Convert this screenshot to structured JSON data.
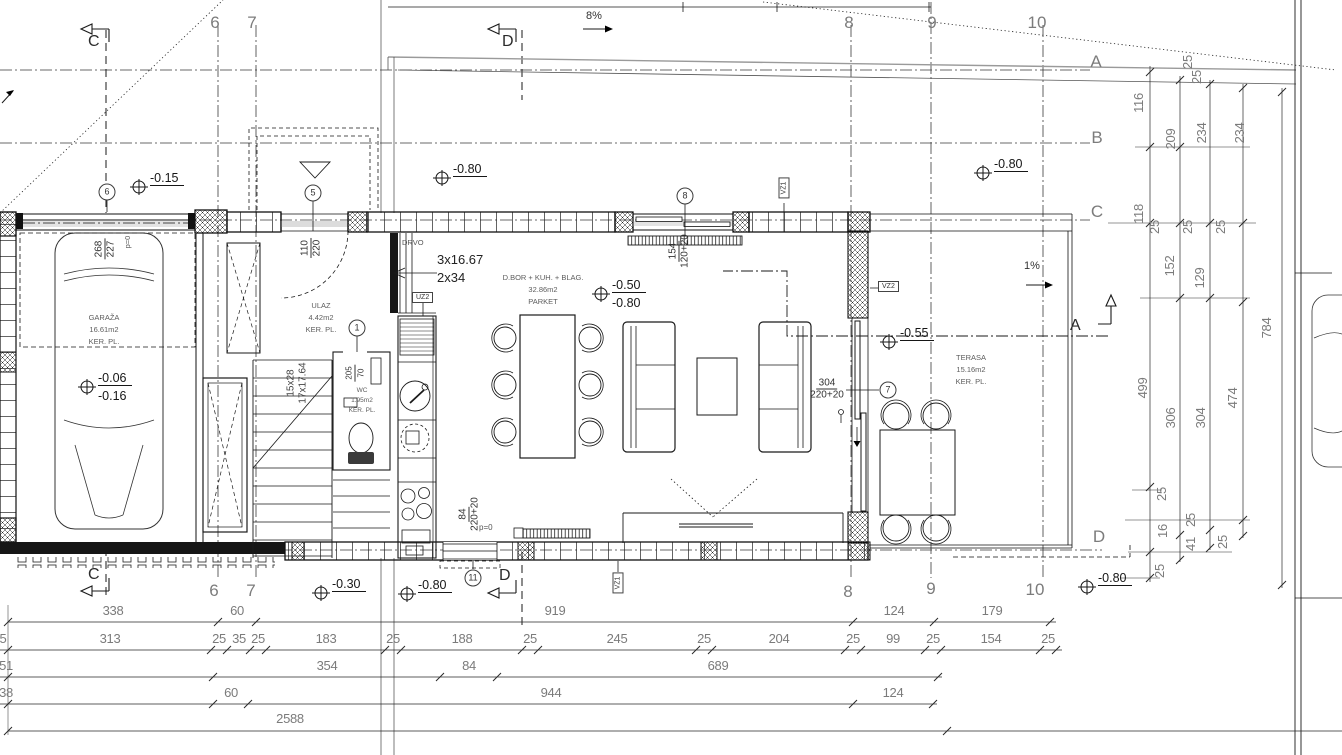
{
  "rooms": {
    "garage": {
      "name": "GARAŽA",
      "area": "16.61m2",
      "floor": "KER. PL."
    },
    "entry": {
      "name": "ULAZ",
      "area": "4.42m2",
      "floor": "KER. PL."
    },
    "wc": {
      "name": "WC",
      "area": "1.95m2",
      "floor": "KER. PL."
    },
    "living": {
      "name": "D.BOR + KUH. + BLAG.",
      "area": "32.86m2",
      "floor": "PARKET"
    },
    "terrace": {
      "name": "TERASA",
      "area": "15.16m2",
      "floor": "KER. PL."
    }
  },
  "sections": {
    "c": "C",
    "d": "D",
    "a": "A"
  },
  "slopes": {
    "driveway": "8%",
    "terrace": "1%"
  },
  "stairs": {
    "note1": "3x16.67",
    "note2": "2x34",
    "flight1": "15x28",
    "flight2": "17x17.64"
  },
  "annotations": {
    "drvo": "DRVO",
    "uz2": "UZ2",
    "vz1": "VZ1",
    "vz2": "VZ2",
    "vz1_bottom": "VZ1",
    "p0_kitchen": "p=0",
    "p0_garage": "p=0"
  },
  "door_dims": {
    "entry_top": "110",
    "entry_bottom": "220",
    "garage_top": "268",
    "garage_bottom": "227",
    "wc_top": "205",
    "wc_bottom": "70",
    "window_top": "154",
    "window_bottom": "120+20",
    "kitchen_top": "84",
    "kitchen_bottom": "220+20",
    "slider_top": "304",
    "slider_bottom": "220+20"
  },
  "grid_labels": [
    {
      "t": "6",
      "x": 215,
      "y": 14
    },
    {
      "t": "7",
      "x": 252,
      "y": 14
    },
    {
      "t": "8",
      "x": 849,
      "y": 14
    },
    {
      "t": "9",
      "x": 932,
      "y": 14
    },
    {
      "t": "10",
      "x": 1037,
      "y": 14
    },
    {
      "t": "6",
      "x": 214,
      "y": 582
    },
    {
      "t": "7",
      "x": 251,
      "y": 582
    },
    {
      "t": "8",
      "x": 848,
      "y": 583
    },
    {
      "t": "9",
      "x": 931,
      "y": 580
    },
    {
      "t": "10",
      "x": 1035,
      "y": 581
    },
    {
      "t": "A",
      "x": 1096,
      "y": 53
    },
    {
      "t": "B",
      "x": 1097,
      "y": 129
    },
    {
      "t": "C",
      "x": 1097,
      "y": 203
    },
    {
      "t": "D",
      "x": 1099,
      "y": 528
    }
  ],
  "position_markers": [
    {
      "t": "6",
      "x": 107,
      "y": 192
    },
    {
      "t": "5",
      "x": 313,
      "y": 193
    },
    {
      "t": "8",
      "x": 685,
      "y": 196
    },
    {
      "t": "1",
      "x": 357,
      "y": 328
    },
    {
      "t": "7",
      "x": 888,
      "y": 390
    },
    {
      "t": "11",
      "x": 473,
      "y": 578
    }
  ],
  "level_markers": [
    {
      "t": "-0.15",
      "x": 150,
      "y": 171,
      "u": 1
    },
    {
      "t": "-0.80",
      "x": 453,
      "y": 162,
      "u": 1
    },
    {
      "t": "-0.80",
      "x": 994,
      "y": 157,
      "u": 1
    },
    {
      "t": "-0.50",
      "x": 612,
      "y": 278,
      "u": 1
    },
    {
      "t": "-0.80",
      "x": 612,
      "y": 296
    },
    {
      "t": "-0.06",
      "x": 98,
      "y": 371,
      "u": 1
    },
    {
      "t": "-0.16",
      "x": 98,
      "y": 389
    },
    {
      "t": "-0.55",
      "x": 900,
      "y": 326,
      "u": 1
    },
    {
      "t": "-0.30",
      "x": 332,
      "y": 577,
      "u": 1
    },
    {
      "t": "-0.80",
      "x": 418,
      "y": 578,
      "u": 1
    },
    {
      "t": "-0.80",
      "x": 1098,
      "y": 571,
      "u": 1
    }
  ],
  "dim_labels_bottom": [
    {
      "t": "338",
      "x": 113,
      "y": 604
    },
    {
      "t": "60",
      "x": 237,
      "y": 604
    },
    {
      "t": "919",
      "x": 555,
      "y": 604
    },
    {
      "t": "124",
      "x": 894,
      "y": 604
    },
    {
      "t": "179",
      "x": 992,
      "y": 604
    },
    {
      "t": "5",
      "x": 3,
      "y": 632
    },
    {
      "t": "313",
      "x": 110,
      "y": 632
    },
    {
      "t": "25",
      "x": 219,
      "y": 632
    },
    {
      "t": "35",
      "x": 239,
      "y": 632
    },
    {
      "t": "25",
      "x": 258,
      "y": 632
    },
    {
      "t": "183",
      "x": 326,
      "y": 632
    },
    {
      "t": "25",
      "x": 393,
      "y": 632
    },
    {
      "t": "188",
      "x": 462,
      "y": 632
    },
    {
      "t": "25",
      "x": 530,
      "y": 632
    },
    {
      "t": "245",
      "x": 617,
      "y": 632
    },
    {
      "t": "25",
      "x": 704,
      "y": 632
    },
    {
      "t": "204",
      "x": 779,
      "y": 632
    },
    {
      "t": "25",
      "x": 853,
      "y": 632
    },
    {
      "t": "99",
      "x": 893,
      "y": 632
    },
    {
      "t": "25",
      "x": 933,
      "y": 632
    },
    {
      "t": "154",
      "x": 991,
      "y": 632
    },
    {
      "t": "25",
      "x": 1048,
      "y": 632
    },
    {
      "t": "51",
      "x": 6,
      "y": 659
    },
    {
      "t": "354",
      "x": 327,
      "y": 659
    },
    {
      "t": "84",
      "x": 469,
      "y": 659
    },
    {
      "t": "689",
      "x": 718,
      "y": 659
    },
    {
      "t": "38",
      "x": 6,
      "y": 686
    },
    {
      "t": "60",
      "x": 231,
      "y": 686
    },
    {
      "t": "944",
      "x": 551,
      "y": 686
    },
    {
      "t": "124",
      "x": 893,
      "y": 686
    },
    {
      "t": "2588",
      "x": 290,
      "y": 712
    }
  ],
  "dim_labels_right": [
    {
      "t": "25",
      "x": 1188,
      "y": 62
    },
    {
      "t": "25",
      "x": 1197,
      "y": 77
    },
    {
      "t": "116",
      "x": 1139,
      "y": 103
    },
    {
      "t": "209",
      "x": 1171,
      "y": 139
    },
    {
      "t": "234",
      "x": 1202,
      "y": 133
    },
    {
      "t": "234",
      "x": 1240,
      "y": 133
    },
    {
      "t": "118",
      "x": 1139,
      "y": 214
    },
    {
      "t": "25",
      "x": 1155,
      "y": 227
    },
    {
      "t": "25",
      "x": 1188,
      "y": 227
    },
    {
      "t": "25",
      "x": 1221,
      "y": 227
    },
    {
      "t": "152",
      "x": 1170,
      "y": 266
    },
    {
      "t": "129",
      "x": 1200,
      "y": 278
    },
    {
      "t": "784",
      "x": 1267,
      "y": 328
    },
    {
      "t": "499",
      "x": 1143,
      "y": 388
    },
    {
      "t": "306",
      "x": 1171,
      "y": 418
    },
    {
      "t": "304",
      "x": 1201,
      "y": 418
    },
    {
      "t": "474",
      "x": 1233,
      "y": 398
    },
    {
      "t": "25",
      "x": 1162,
      "y": 494
    },
    {
      "t": "16",
      "x": 1163,
      "y": 531
    },
    {
      "t": "25",
      "x": 1191,
      "y": 520
    },
    {
      "t": "41",
      "x": 1191,
      "y": 544
    },
    {
      "t": "25",
      "x": 1223,
      "y": 542
    },
    {
      "t": "25",
      "x": 1160,
      "y": 571
    }
  ]
}
